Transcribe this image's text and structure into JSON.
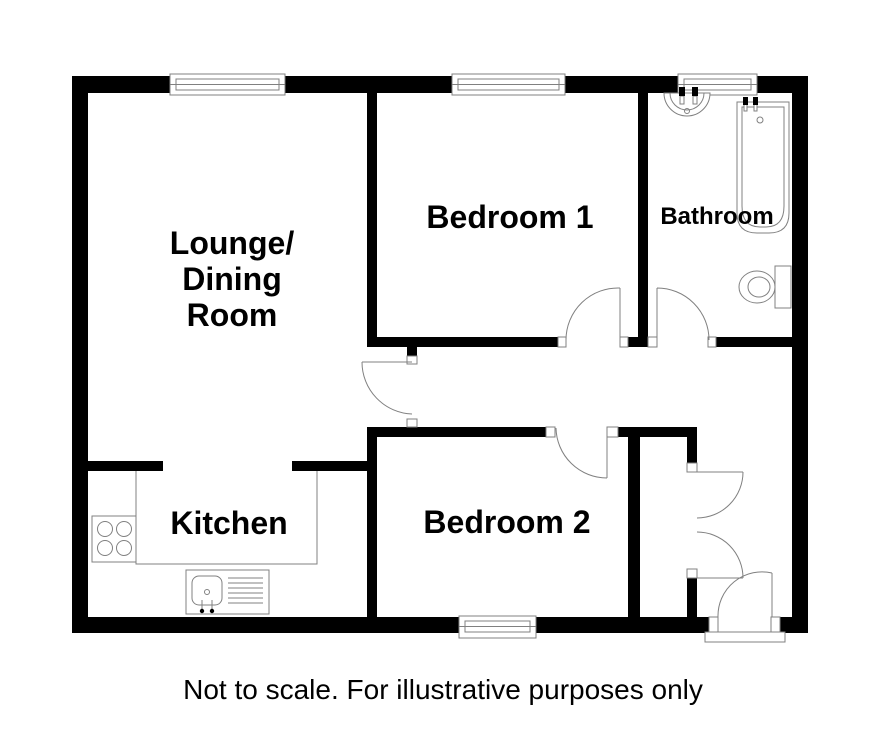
{
  "colors": {
    "wall": "#000000",
    "line": "#808080",
    "background": "#ffffff",
    "text": "#000000"
  },
  "labels": {
    "lounge": {
      "line1": "Lounge/",
      "line2": "Dining",
      "line3": "Room"
    },
    "bedroom1": "Bedroom 1",
    "bathroom": "Bathroom",
    "kitchen": "Kitchen",
    "bedroom2": "Bedroom 2"
  },
  "footer": {
    "note": "Not to scale. For illustrative purposes only"
  },
  "icons": {
    "fixtures": [
      "wash-basin-icon",
      "bathtub-icon",
      "toilet-icon",
      "hob-icon",
      "kitchen-sink-icon",
      "window-icon",
      "door-arc-icon",
      "front-door-threshold"
    ]
  }
}
